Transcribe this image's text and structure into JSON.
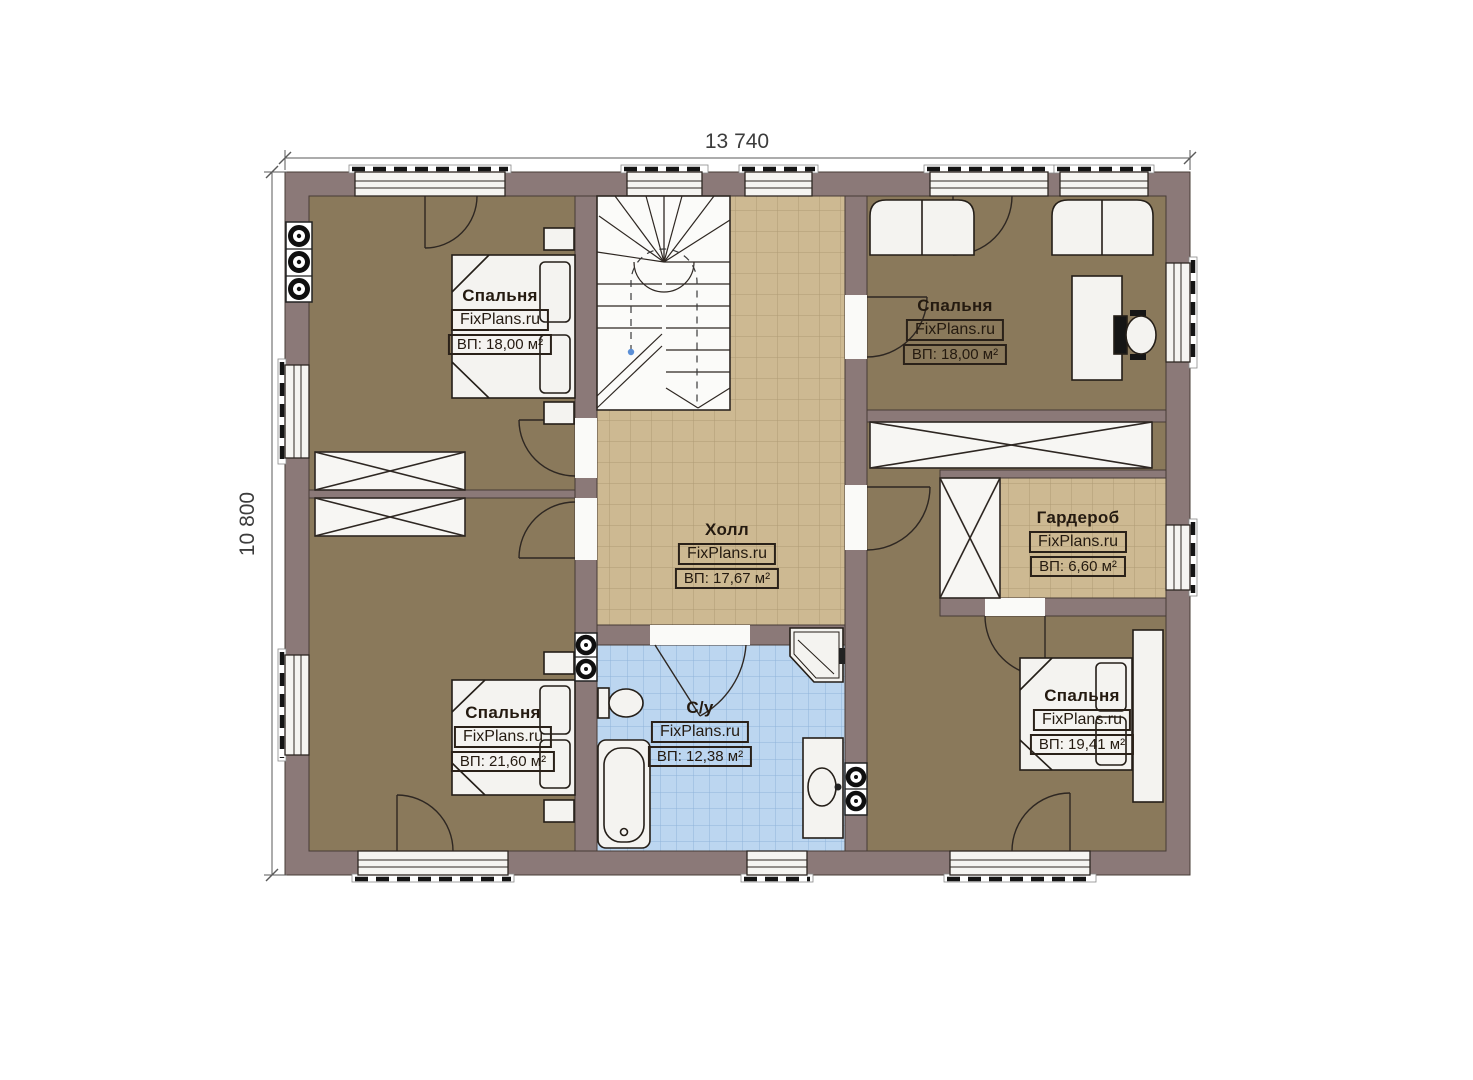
{
  "plan": {
    "dim_top": "13 740",
    "dim_left": "10 800"
  },
  "rooms": [
    {
      "id": "bedroom-top-left",
      "name": "Спальня",
      "watermark": "FixPlans.ru",
      "area": "ВП: 18,00 м²"
    },
    {
      "id": "bedroom-top-right",
      "name": "Спальня",
      "watermark": "FixPlans.ru",
      "area": "ВП: 18,00 м²"
    },
    {
      "id": "hall",
      "name": "Холл",
      "watermark": "FixPlans.ru",
      "area": "ВП: 17,67 м²"
    },
    {
      "id": "wardrobe",
      "name": "Гардероб",
      "watermark": "FixPlans.ru",
      "area": "ВП: 6,60 м²"
    },
    {
      "id": "bedroom-bottom-left",
      "name": "Спальня",
      "watermark": "FixPlans.ru",
      "area": "ВП: 21,60 м²"
    },
    {
      "id": "bathroom",
      "name": "С/у",
      "watermark": "FixPlans.ru",
      "area": "ВП: 12,38 м²"
    },
    {
      "id": "bedroom-bottom-right",
      "name": "Спальня",
      "watermark": "FixPlans.ru",
      "area": "ВП: 19,41 м²"
    }
  ],
  "colors": {
    "wall": "#8B7978",
    "bedroom_floor": "#8A795B",
    "hall_tile": "#CDB992",
    "bath_tile": "#BCD6F0",
    "fixture": "#F4F3F0",
    "outline": "#2E2722"
  }
}
